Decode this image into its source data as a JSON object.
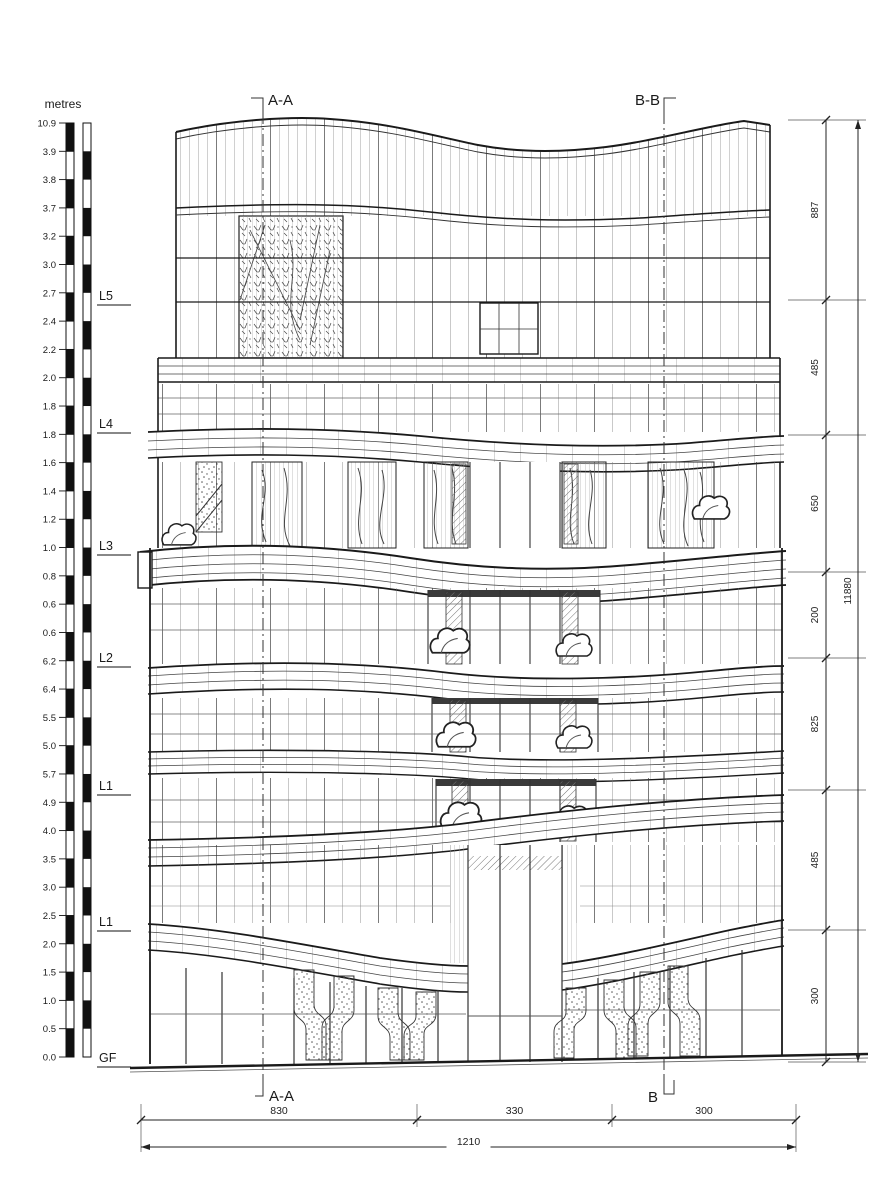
{
  "drawing": {
    "type": "architectural-elevation",
    "ink_color": "#1a1a1a",
    "paper_color": "#ffffff"
  },
  "scale_bar": {
    "title": "metres",
    "ticks": [
      "10.9",
      "3.9",
      "3.8",
      "3.7",
      "3.2",
      "3.0",
      "2.7",
      "2.4",
      "2.2",
      "2.0",
      "1.8",
      "1.8",
      "1.6",
      "1.4",
      "1.2",
      "1.0",
      "0.8",
      "0.6",
      "0.6",
      "6.2",
      "6.4",
      "5.5",
      "5.0",
      "5.7",
      "4.9",
      "4.0",
      "3.5",
      "3.0",
      "2.5",
      "2.0",
      "1.5",
      "1.0",
      "0.5",
      "0.0"
    ]
  },
  "levels": [
    {
      "label": "L5",
      "y": 296
    },
    {
      "label": "L4",
      "y": 424
    },
    {
      "label": "L3",
      "y": 546
    },
    {
      "label": "L2",
      "y": 658
    },
    {
      "label": "L1",
      "y": 786
    },
    {
      "label": "L1",
      "y": 922
    },
    {
      "label": "GF",
      "y": 1058
    }
  ],
  "section_markers": {
    "top_left": "A-A",
    "top_right": "B-B",
    "bottom_left": "A-A",
    "bottom_right": "B"
  },
  "dimensions": {
    "right_segments": [
      {
        "label": "887",
        "y1": 120,
        "y2": 300
      },
      {
        "label": "485",
        "y1": 300,
        "y2": 435
      },
      {
        "label": "650",
        "y1": 435,
        "y2": 572
      },
      {
        "label": "200",
        "y1": 572,
        "y2": 658
      },
      {
        "label": "825",
        "y1": 658,
        "y2": 790
      },
      {
        "label": "485",
        "y1": 790,
        "y2": 930
      },
      {
        "label": "300",
        "y1": 930,
        "y2": 1062
      }
    ],
    "right_total": {
      "label": "11880",
      "y1": 120,
      "y2": 1062
    },
    "bottom_segments": [
      {
        "label": "830",
        "x1": 141,
        "x2": 417
      },
      {
        "label": "330",
        "x1": 417,
        "x2": 612
      },
      {
        "label": "300",
        "x1": 612,
        "x2": 796
      }
    ],
    "bottom_total": {
      "label": "1210",
      "x1": 141,
      "x2": 796
    }
  }
}
